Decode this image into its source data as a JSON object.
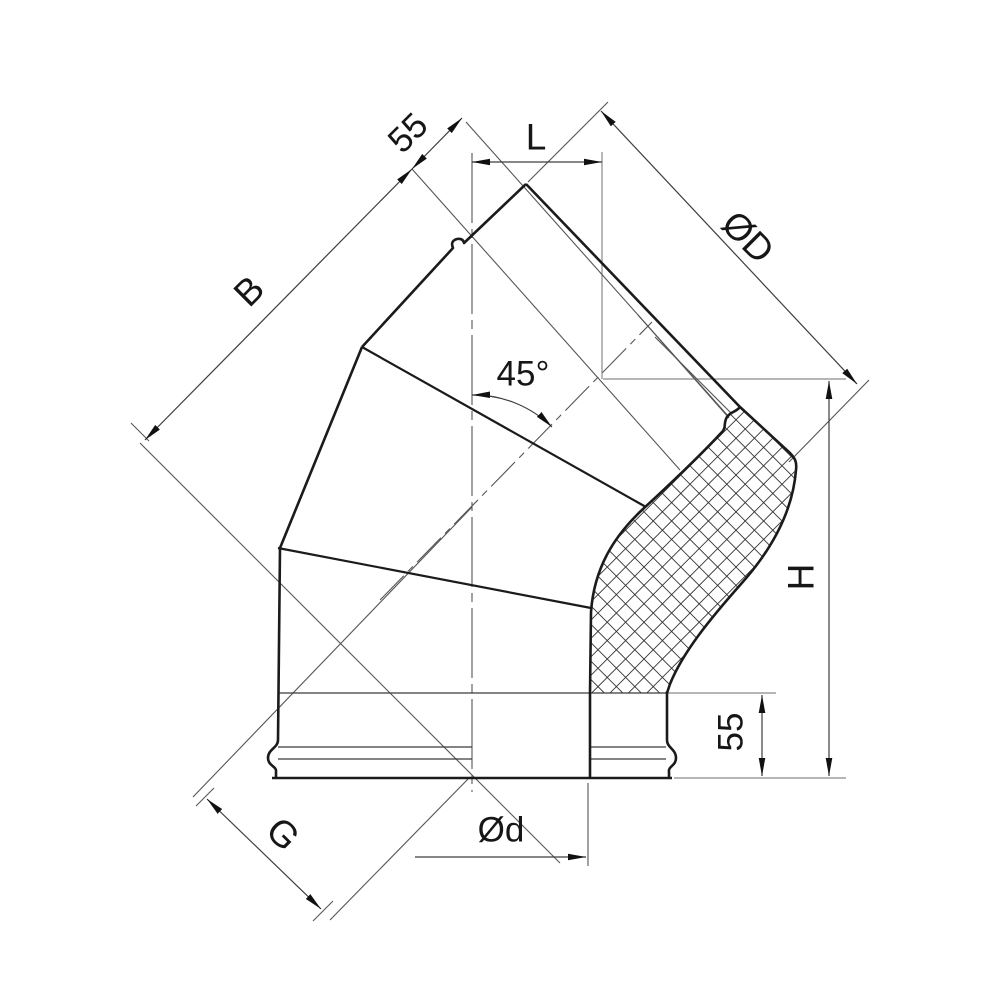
{
  "page": {
    "background": "#ffffff"
  },
  "colors": {
    "outline": "#1b1b1b",
    "thin_line": "#555555",
    "reference_line": "#8a8a8a",
    "hatch_line": "#333333"
  },
  "dimensions": {
    "socket_depth_top": {
      "label": "55"
    },
    "mouth_width": {
      "label": "L"
    },
    "outer_diameter": {
      "label": "ØD"
    },
    "side_length": {
      "label": "B"
    },
    "bend_angle": {
      "label": "45°"
    },
    "overall_height": {
      "label": "H"
    },
    "socket_depth_bottom": {
      "label": "55"
    },
    "spigot_length": {
      "label": "G"
    },
    "inner_diameter": {
      "label": "Ød"
    }
  }
}
